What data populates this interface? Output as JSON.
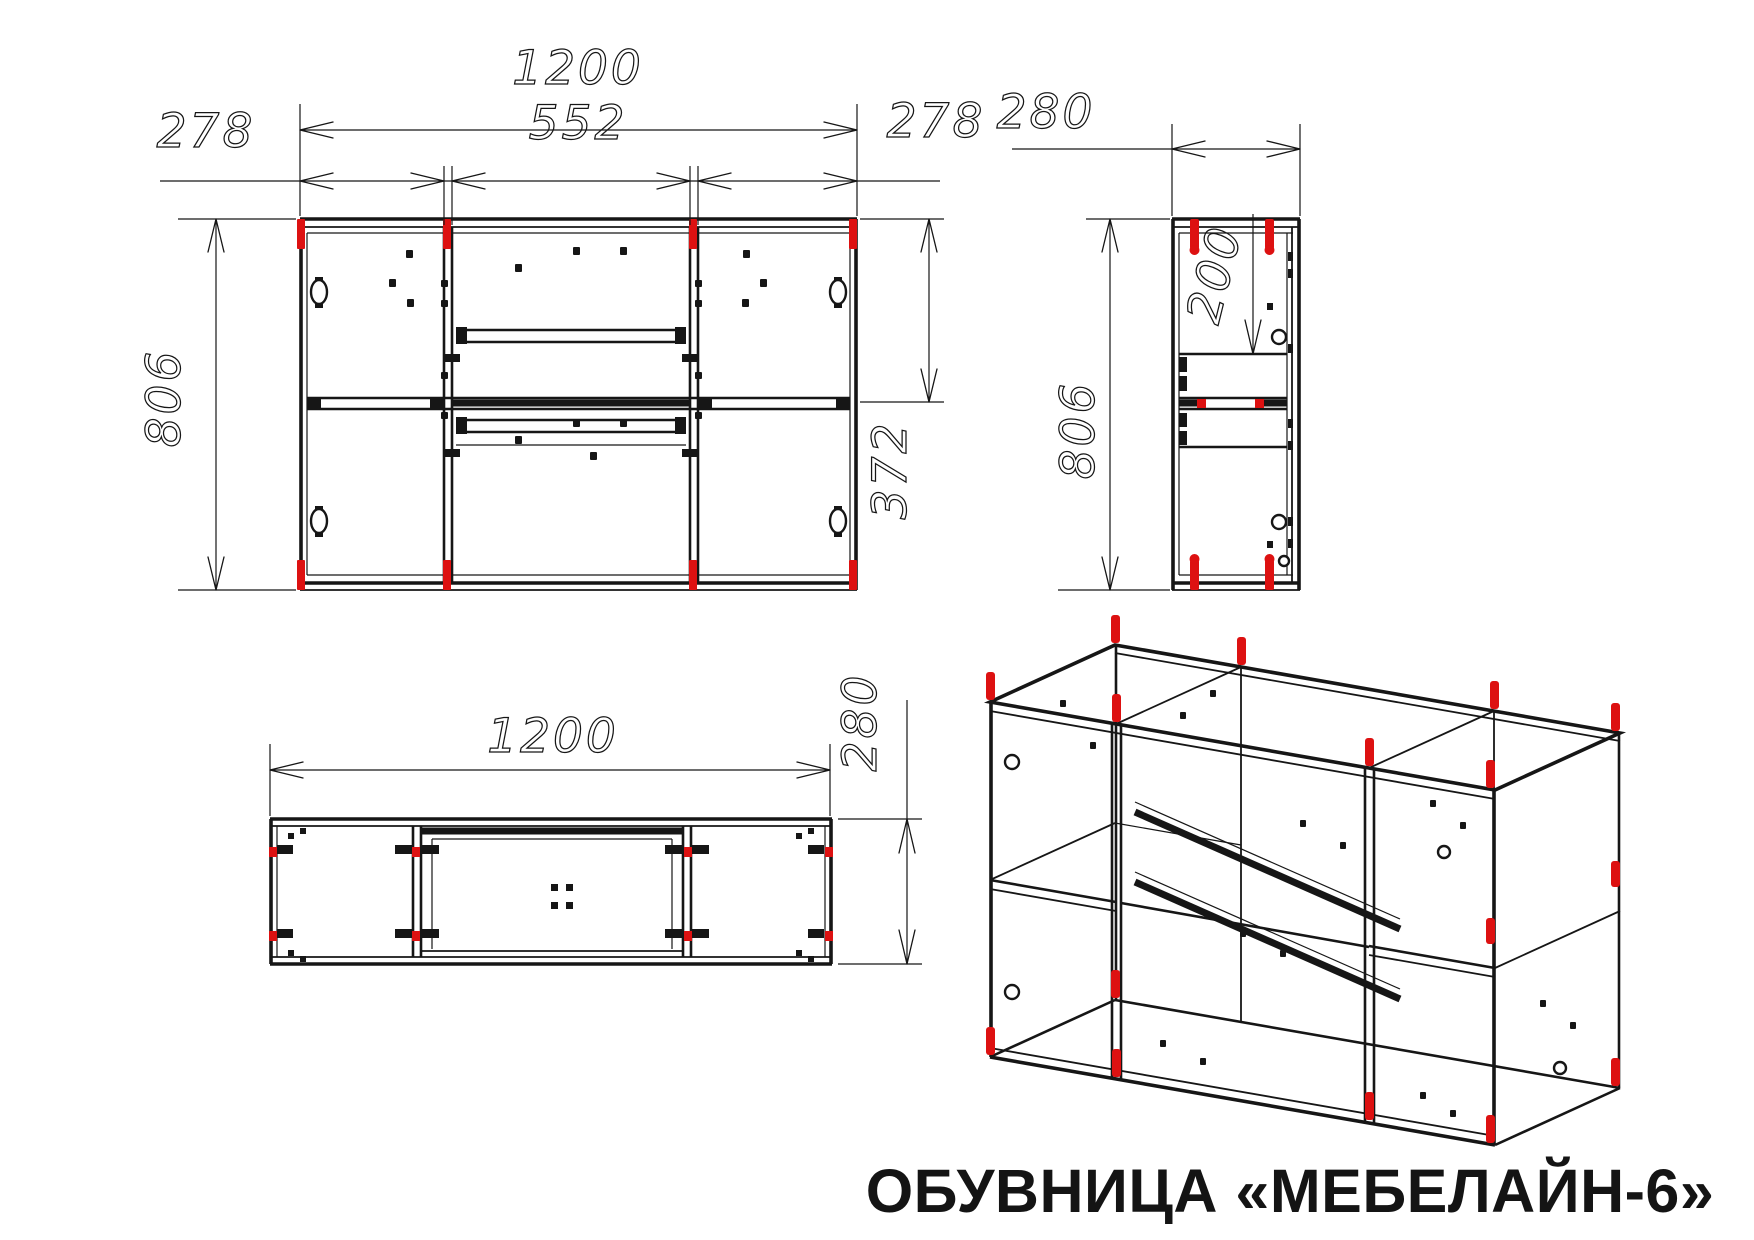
{
  "sheet": {
    "title": "ОБУВНИЦА «МЕБЕЛАЙН-6»"
  },
  "colors": {
    "line": "#161616",
    "pin_red": "#dd1111",
    "background": "#ffffff"
  },
  "views": {
    "front": {
      "dims": {
        "total_width": "1200",
        "left_section_width": "278",
        "center_section_width": "552",
        "right_section_width": "278",
        "total_height": "806",
        "top_to_shelf": "372"
      }
    },
    "side": {
      "dims": {
        "depth": "280",
        "top_to_first_shelf": "200",
        "total_height": "806"
      }
    },
    "plan": {
      "dims": {
        "total_width": "1200",
        "depth": "280"
      }
    }
  }
}
